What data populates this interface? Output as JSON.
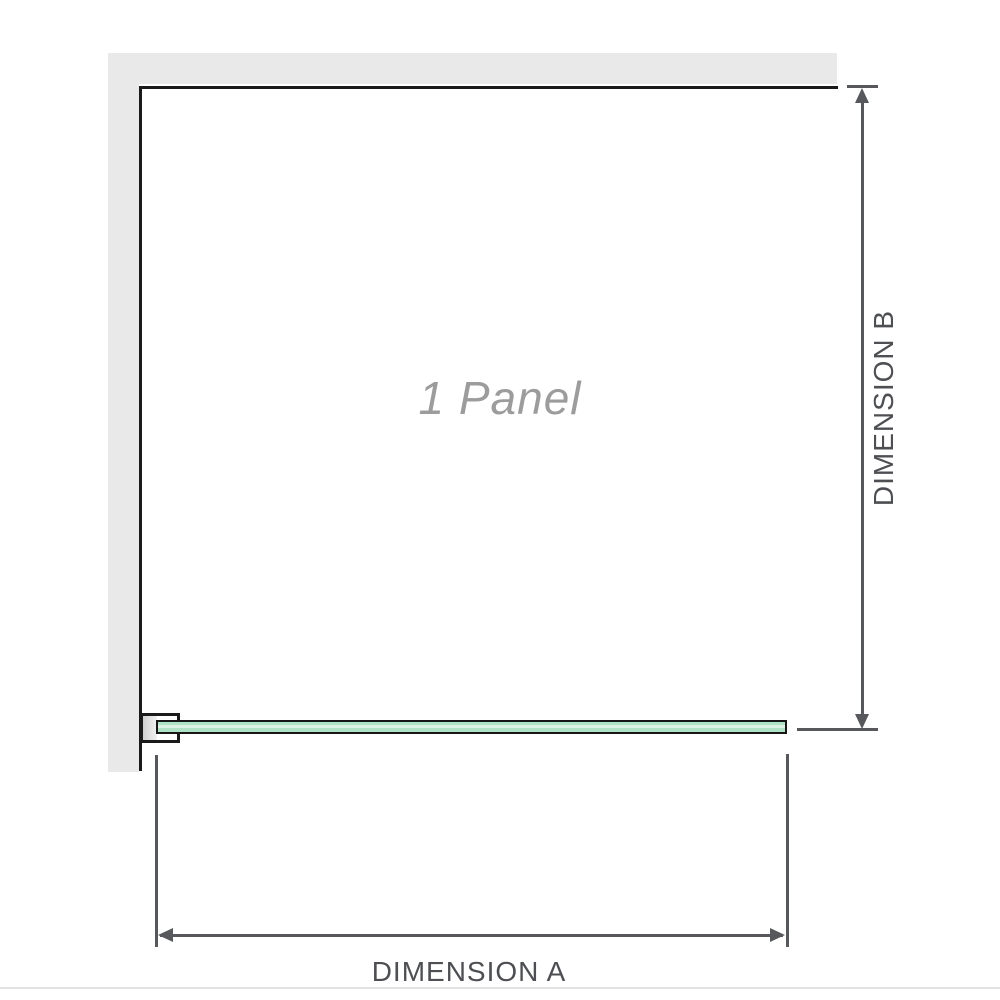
{
  "diagram": {
    "panel_label": "1 Panel",
    "dimension_a_label": "DIMENSION A",
    "dimension_b_label": "DIMENSION B"
  },
  "colors": {
    "wall": "#e9e9e9",
    "outline": "#1a1a1a",
    "dimension": "#57585b",
    "glass_fill": "#b0e2c5",
    "glass_highlight": "#ddf1e4",
    "label_text": "#4d4f53",
    "panel_text": "#9c9c9c",
    "bottom_rule": "#e3e3e3"
  }
}
